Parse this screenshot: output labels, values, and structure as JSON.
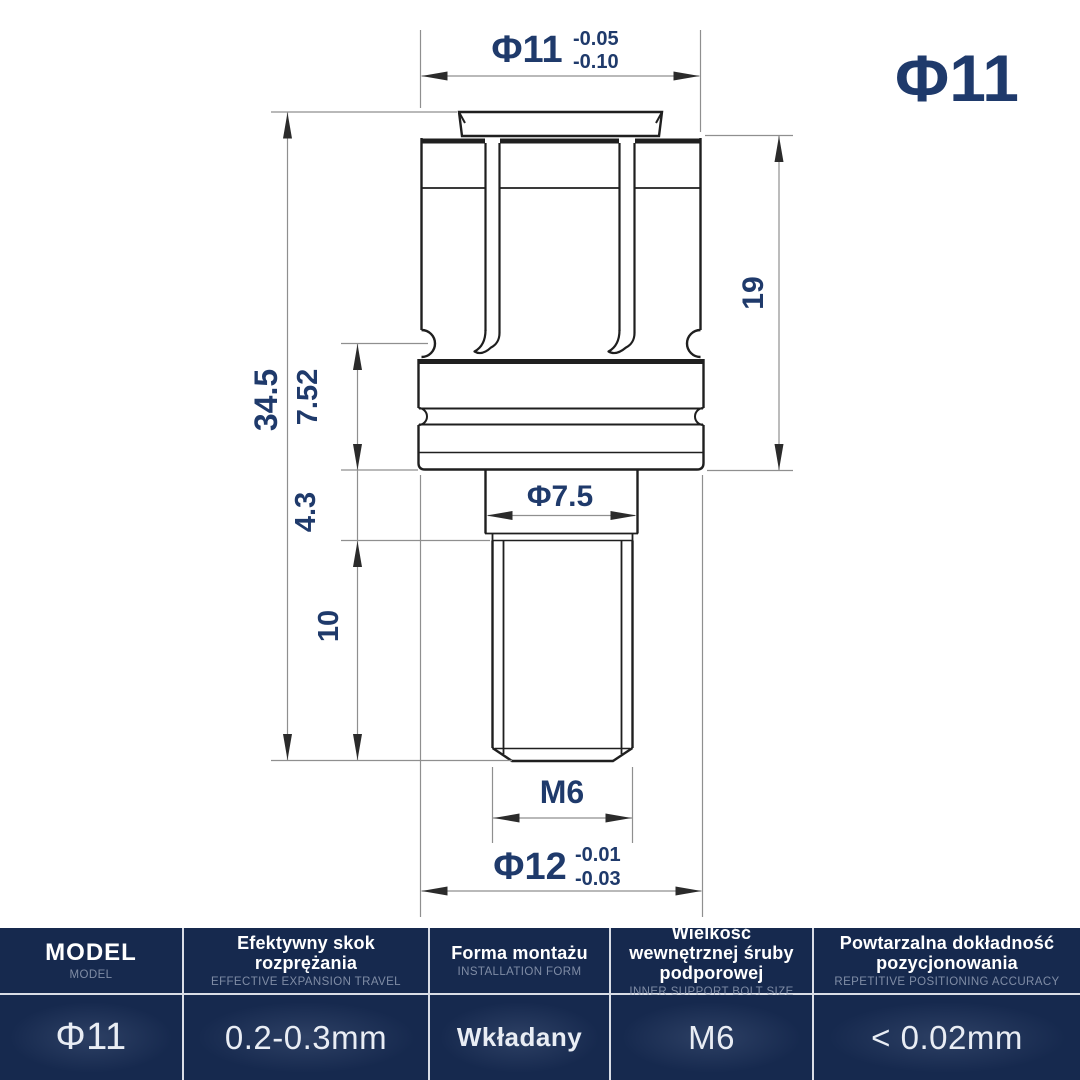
{
  "badge": {
    "label": "Φ11"
  },
  "drawing": {
    "dims": {
      "top_diameter": {
        "label": "Φ11",
        "tol_upper": "-0.05",
        "tol_lower": "-0.10"
      },
      "head_height": {
        "label": "19"
      },
      "total_height": {
        "label": "34.5"
      },
      "collar_height": {
        "label": "7.52"
      },
      "shoulder_height": {
        "label": "4.3"
      },
      "thread_length": {
        "label": "10"
      },
      "shoulder_diameter": {
        "label": "Φ7.5"
      },
      "thread_size": {
        "label": "M6"
      },
      "flange_diameter": {
        "label": "Φ12",
        "tol_upper": "-0.01",
        "tol_lower": "-0.03"
      }
    },
    "colors": {
      "outline": "#1f1f1f",
      "dimension_line": "#8f8f8f",
      "dimension_text": "#1f3a6b"
    }
  },
  "spec_table": {
    "background": "#16294e",
    "columns": [
      {
        "pl": "MODEL",
        "en": "MODEL",
        "value": "Φ11"
      },
      {
        "pl": "Efektywny skok rozprężania",
        "en": "EFFECTIVE EXPANSION TRAVEL",
        "value": "0.2-0.3mm"
      },
      {
        "pl": "Forma montażu",
        "en": "INSTALLATION FORM",
        "value": "Wkładany"
      },
      {
        "pl": "Wielkość wewnętrznej śruby podporowej",
        "en": "INNER SUPPORT BOLT SIZE",
        "value": "M6"
      },
      {
        "pl": "Powtarzalna dokładność pozycjonowania",
        "en": "REPETITIVE POSITIONING ACCURACY",
        "value": "< 0.02mm"
      }
    ]
  }
}
